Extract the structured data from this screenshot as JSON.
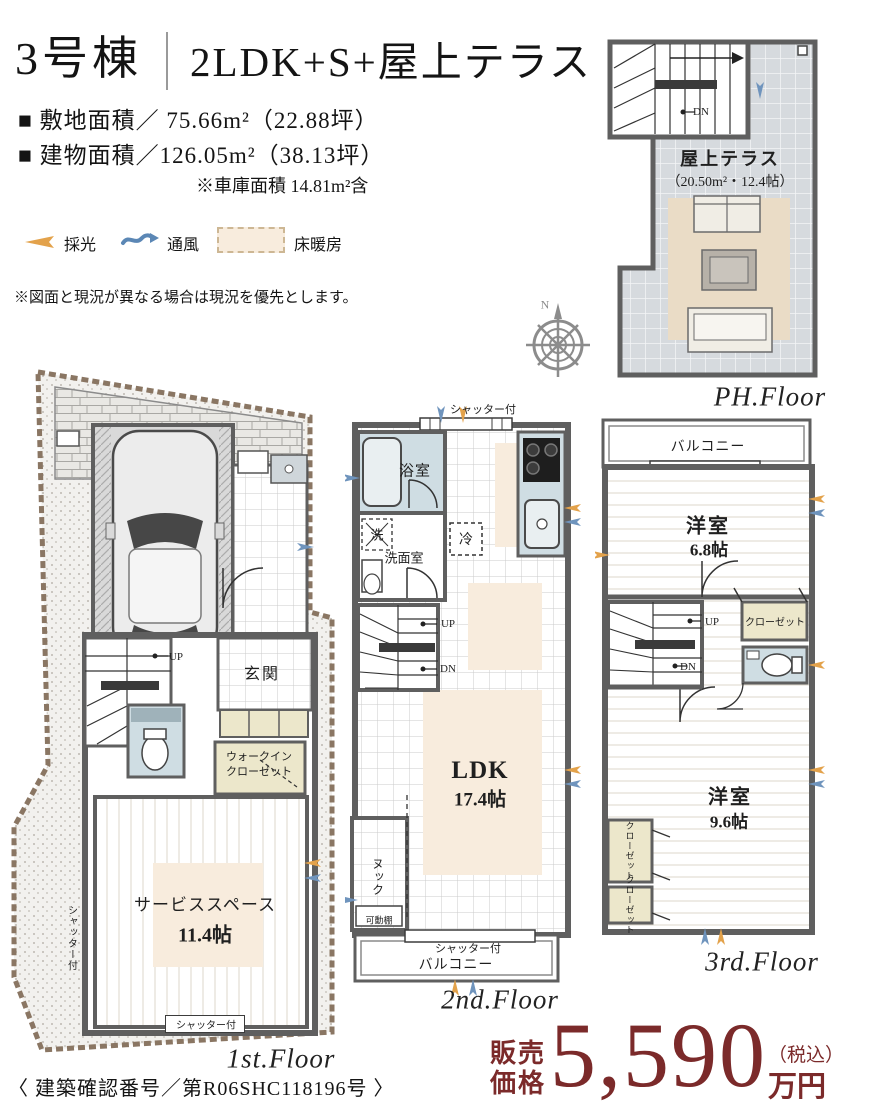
{
  "header": {
    "building_no": "3号棟",
    "plan_type": "2LDK+S+屋上テラス",
    "site_area": "■ 敷地面積／ 75.66m²（22.88坪）",
    "building_area": "■ 建物面積／126.05m²（38.13坪）",
    "garage_note": "※車庫面積 14.81m²含"
  },
  "legend": {
    "daylight": "採光",
    "ventilation": "通風",
    "floor_heating": "床暖房",
    "disclaimer": "※図面と現況が異なる場合は現況を優先とします。"
  },
  "compass": {
    "north": "N"
  },
  "floors": {
    "ph": {
      "name": "PH.Floor",
      "terrace": "屋上テラス",
      "terrace_area": "（20.50m²・12.4帖）",
      "dn": "DN"
    },
    "f1": {
      "name": "1st.Floor",
      "up": "UP",
      "entrance": "玄関",
      "wic_line1": "ウォークイン",
      "wic_line2": "クローゼット",
      "service": "サービススペース",
      "service_area": "11.4帖",
      "shutter_left": "シャッター付",
      "shutter_bottom": "シャッター付"
    },
    "f2": {
      "name": "2nd.Floor",
      "shutter_top": "シャッター付",
      "bath": "浴室",
      "washer": "洗",
      "washroom": "洗面室",
      "fridge": "冷",
      "up": "UP",
      "dn": "DN",
      "ldk": "LDK",
      "ldk_area": "17.4帖",
      "nook": "ヌック",
      "movable_shelf": "可動棚",
      "shutter_bottom": "シャッター付",
      "balcony": "バルコニー"
    },
    "f3": {
      "name": "3rd.Floor",
      "balcony": "バルコニー",
      "room_a": "洋室",
      "room_a_area": "6.8帖",
      "up": "UP",
      "dn": "DN",
      "closet_right": "クローゼット",
      "room_b": "洋室",
      "room_b_area": "9.6帖",
      "closet_left_1": "クローゼット",
      "closet_left_2": "クローゼット"
    }
  },
  "price": {
    "label_line1": "販売",
    "label_line2": "価格",
    "amount": "5,590",
    "tax_note": "（税込）",
    "unit": "万円"
  },
  "footer": {
    "confirmation_no": "〈 建築確認番号／第R06SHC118196号 〉"
  },
  "colors": {
    "accent_red": "#7b2a2a",
    "wall_gray": "#5f5f5f",
    "floor_heating": "#f8ecdd",
    "bath_blue": "#cfdde3",
    "closet_beige": "#ece7cb",
    "terrace_tile": "#d6dade",
    "daylight_orange": "#e3a24b",
    "ventilation_blue": "#5b87b5"
  }
}
